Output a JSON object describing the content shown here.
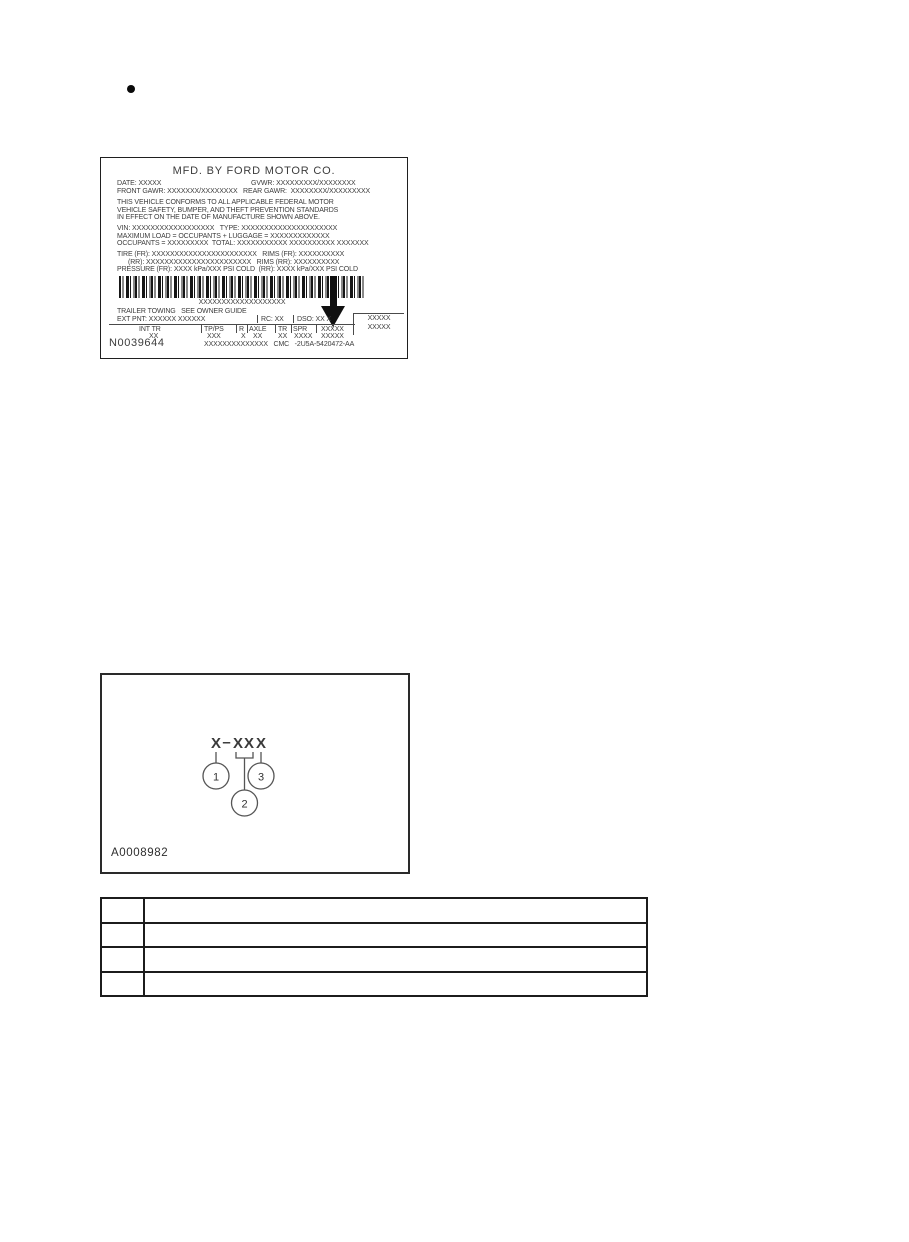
{
  "ink_color": "#3c3c3c",
  "bullet_glyph": "•",
  "certification_label": {
    "title": "MFD. BY FORD MOTOR CO.",
    "date": "DATE: XXXXX",
    "gvwr": "GVWR: XXXXXXXXX/XXXXXXXX",
    "gawr": "FRONT GAWR: XXXXXXX/XXXXXXXX   REAR GAWR:  XXXXXXXX/XXXXXXXXX",
    "conformity_line1": "THIS VEHICLE CONFORMS TO ALL APPLICABLE FEDERAL MOTOR",
    "conformity_line2": "VEHICLE SAFETY, BUMPER, AND THEFT PREVENTION STANDARDS",
    "conformity_line3": "IN EFFECT ON THE DATE OF MANUFACTURE SHOWN ABOVE.",
    "vin_type": "VIN: XXXXXXXXXXXXXXXXXX   TYPE: XXXXXXXXXXXXXXXXXXXXX",
    "max_load": "MAXIMUM LOAD = OCCUPANTS + LUGGAGE = XXXXXXXXXXXXX",
    "occupants": "OCCUPANTS = XXXXXXXXX  TOTAL: XXXXXXXXXXX XXXXXXXXXX XXXXXXX",
    "tire_fr": "TIRE (FR): XXXXXXXXXXXXXXXXXXXXXXX   RIMS (FR): XXXXXXXXXX",
    "tire_rr": "(RR): XXXXXXXXXXXXXXXXXXXXXXX   RIMS (RR): XXXXXXXXXX",
    "pressure": "PRESSURE (FR): XXXX kPa/XXX PSI COLD  (RR): XXXX kPa/XXX PSI COLD",
    "barcode_text": "XXXXXXXXXXXXXXXXXXX",
    "trailer_towing": "TRAILER TOWING   SEE OWNER GUIDE",
    "ext_pnt": "EXT PNT: XXXXXX XXXXXX",
    "rc": "RC: XX",
    "dso": "DSO: XX X",
    "side_box_line1": "XXXXX",
    "side_box_line2": "XXXXX",
    "grid_headers": [
      "INT TR",
      "TP/PS",
      "R",
      "AXLE",
      "TR",
      "SPR",
      "XXXXX"
    ],
    "grid_values": [
      "XX",
      "XXX",
      "X",
      "XX",
      "XX",
      "XXXX",
      "XXXXX"
    ],
    "footer_line": "XXXXXXXXXXXXXX   CMC   -2U5A-5420472-AA",
    "figure_id": "N0039644"
  },
  "code_diagram": {
    "code_char1": "X",
    "code_dash": "–",
    "code_char2": "XX",
    "code_char3": "X",
    "callout_1": "1",
    "callout_2": "2",
    "callout_3": "3",
    "figure_id": "A0008982"
  },
  "description_table": {
    "rows": [
      {
        "num": "",
        "desc": ""
      },
      {
        "num": "",
        "desc": ""
      },
      {
        "num": "",
        "desc": ""
      },
      {
        "num": "",
        "desc": ""
      }
    ]
  }
}
